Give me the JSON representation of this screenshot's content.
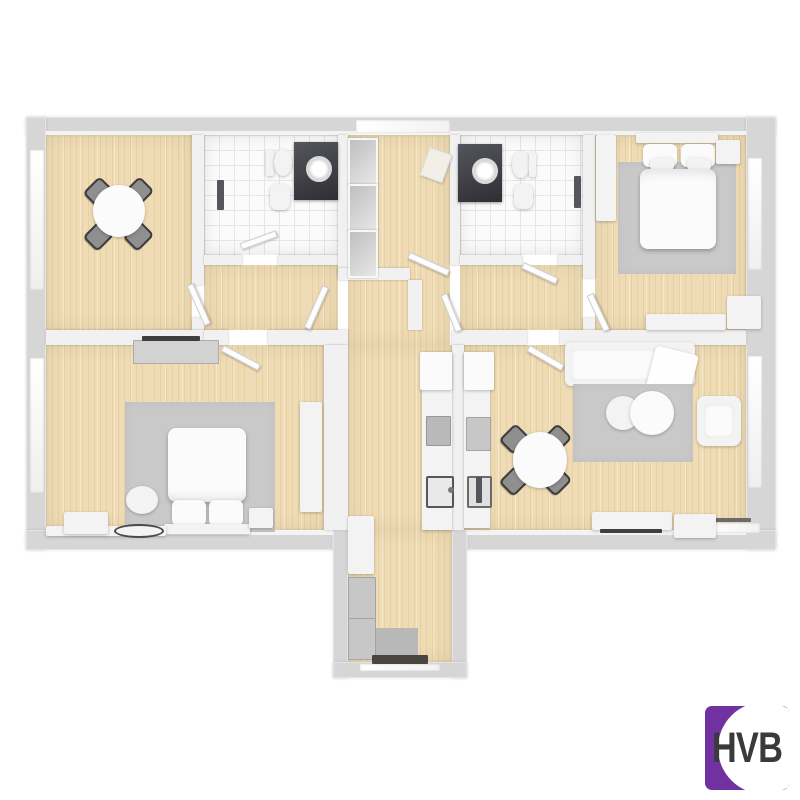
{
  "scene": {
    "type": "3D floor plan render, top-down view of an apartment",
    "background": "#ffffff"
  },
  "logo": {
    "text": "HVB"
  },
  "colors": {
    "background": "#ffffff",
    "wall_outer": "#d6d6d6",
    "wall_inner": "#f1f1f1",
    "wood": "#f0dcb4",
    "wood_grain": "rgba(176,136,74,0.14)",
    "tile": "#fbfbfb",
    "tile_grout": "#e6e6e6",
    "rug": "#c9c9c9",
    "furniture": "#f3f3f3",
    "chair": "#8f8f8f",
    "dark_fixture": "#3e3e44",
    "appliance": "#c7c7c7",
    "logo_purple": "#7231A0",
    "logo_text": "#3a3a3c"
  },
  "rooms": [
    {
      "name": "dining-room",
      "position": "top-left",
      "floor": "wood",
      "furniture": [
        "round-table",
        "4 chairs"
      ]
    },
    {
      "name": "bathroom-1",
      "position": "top-center-left",
      "floor": "white-tile",
      "furniture": [
        "toilet",
        "bidet",
        "dark-vanity-with-round-sink",
        "radiator"
      ]
    },
    {
      "name": "entrance-hall",
      "position": "top-center",
      "floor": "wood",
      "furniture": [
        "glass-front-wardrobe-3-cells",
        "doormat"
      ]
    },
    {
      "name": "bathroom-2",
      "position": "top-center-right",
      "floor": "white-tile",
      "furniture": [
        "dark-vanity-with-round-sink",
        "toilet",
        "bidet",
        "radiator"
      ]
    },
    {
      "name": "bedroom-1",
      "position": "top-right",
      "floor": "wood",
      "furniture": [
        "double-bed",
        "gray-rug",
        "nightstand",
        "wardrobe",
        "sideboard",
        "dresser"
      ]
    },
    {
      "name": "bedroom-2",
      "position": "bottom-left",
      "floor": "wood",
      "furniture": [
        "double-bed",
        "gray-rug",
        "round-pouf",
        "nightstand",
        "dresser-with-tv",
        "wardrobe",
        "low-bench",
        "oval-mat"
      ]
    },
    {
      "name": "kitchen-corridor",
      "position": "center, extends below footprint",
      "floor": "wood",
      "furniture": [
        "counter",
        "stove",
        "sink",
        "tall-cabinets",
        "fridge",
        "oven",
        "washer",
        "dryer",
        "gray-mat",
        "balcony-threshold"
      ]
    },
    {
      "name": "living-room",
      "position": "bottom-right",
      "floor": "wood",
      "furniture": [
        "sofa-with-throw",
        "gray-rug",
        "2 round-coffee-tables",
        "armchair",
        "round-dining-table",
        "4 chairs",
        "tv-sideboard",
        "cabinet",
        "radiator"
      ]
    }
  ],
  "counts": {
    "door_leaves": 9,
    "windows": 6
  }
}
